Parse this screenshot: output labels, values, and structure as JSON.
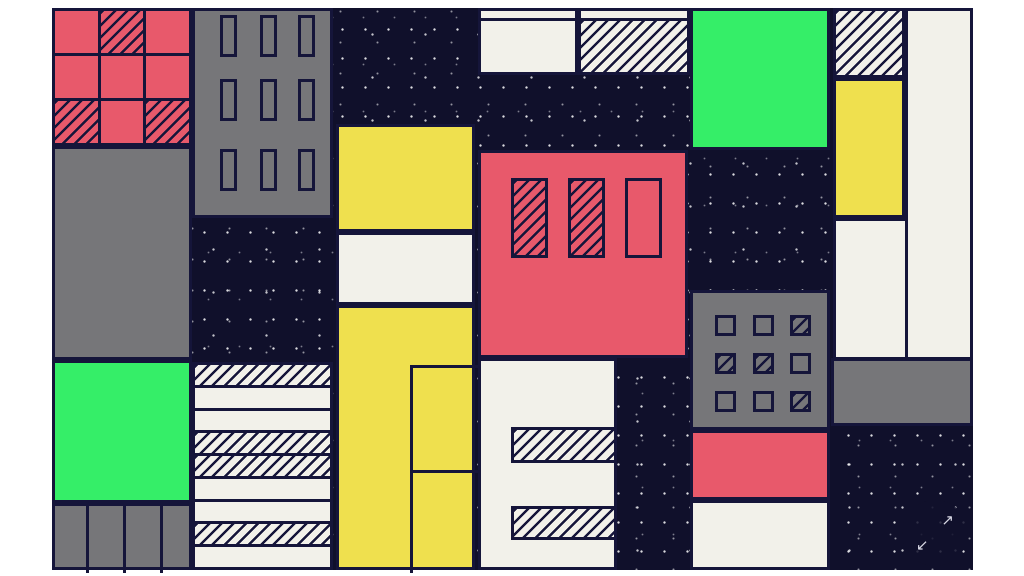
{
  "page": {
    "background": "#ffffff"
  },
  "artwork": {
    "description": "abstract geometric city-blocks illustration with hatched and speckled textures",
    "palette": {
      "navy": "#10102b",
      "red": "#e8596b",
      "gray": "#767679",
      "green": "#35ee68",
      "yellow": "#efe04e",
      "cream": "#f2f1ea",
      "line": "#15153a",
      "speckle": "#ffffff"
    },
    "canvas": {
      "x": 52,
      "y": 8,
      "width": 921,
      "height": 562
    },
    "blocks": [
      {
        "name": "red-grid",
        "x": 0,
        "y": 0,
        "w": 140,
        "h": 138,
        "fill": "red",
        "grid": {
          "rows": 3,
          "cols": 3,
          "hatch": [
            [
              0,
              1
            ],
            [
              2,
              0
            ],
            [
              2,
              2
            ]
          ]
        }
      },
      {
        "name": "left-gray-block",
        "x": 0,
        "y": 138,
        "w": 140,
        "h": 214,
        "fill": "gray"
      },
      {
        "name": "left-green-block",
        "x": 0,
        "y": 352,
        "w": 140,
        "h": 143,
        "fill": "green"
      },
      {
        "name": "left-gray-columns",
        "x": 0,
        "y": 495,
        "w": 140,
        "h": 67,
        "fill": "gray",
        "vlines": [
          31,
          68,
          105
        ]
      },
      {
        "name": "gray-building-top",
        "x": 140,
        "y": 0,
        "w": 141,
        "h": 210,
        "fill": "gray",
        "windows": {
          "cols": [
            25,
            65,
            103
          ],
          "rows": [
            4,
            68,
            138
          ],
          "w": 17,
          "h": 42,
          "hatch": []
        }
      },
      {
        "name": "stripe-building",
        "x": 140,
        "y": 354,
        "w": 141,
        "h": 208,
        "fill": "cream",
        "bands": [
          "hatch",
          "cream",
          "cream",
          "hatch",
          "hatch",
          "cream",
          "cream",
          "hatch",
          "cream"
        ]
      },
      {
        "name": "top-cream-strip-left",
        "x": 426,
        "y": 0,
        "w": 100,
        "h": 13,
        "fill": "cream"
      },
      {
        "name": "top-cream-strip-right",
        "x": 526,
        "y": 0,
        "w": 112,
        "h": 13,
        "fill": "cream"
      },
      {
        "name": "top-cream-left",
        "x": 426,
        "y": 10,
        "w": 100,
        "h": 57,
        "fill": "cream"
      },
      {
        "name": "top-hatch-right",
        "x": 526,
        "y": 10,
        "w": 112,
        "h": 57,
        "fill": "hatch"
      },
      {
        "name": "yellow-top-block",
        "x": 284,
        "y": 116,
        "w": 139,
        "h": 108,
        "fill": "yellow"
      },
      {
        "name": "center-cream-band",
        "x": 284,
        "y": 224,
        "w": 139,
        "h": 73,
        "fill": "cream"
      },
      {
        "name": "yellow-column",
        "x": 284,
        "y": 297,
        "w": 139,
        "h": 265,
        "fill": "yellow",
        "lines": [
          {
            "x": 71,
            "y": 57,
            "w": 3,
            "h": 208
          },
          {
            "x": 71,
            "y": 57,
            "w": 68,
            "h": 3
          },
          {
            "x": 71,
            "y": 162,
            "w": 68,
            "h": 3
          }
        ]
      },
      {
        "name": "red-building",
        "x": 426,
        "y": 142,
        "w": 210,
        "h": 208,
        "fill": "red",
        "windows": {
          "cols": [
            30,
            87,
            144
          ],
          "rows": [
            25
          ],
          "w": 37,
          "h": 80,
          "hatch": [
            [
              0,
              0
            ],
            [
              0,
              1
            ]
          ]
        }
      },
      {
        "name": "bottom-cream-center",
        "x": 426,
        "y": 350,
        "w": 139,
        "h": 212,
        "fill": "cream",
        "bars": [
          {
            "x": 30,
            "y": 66,
            "w": 106,
            "h": 36
          },
          {
            "x": 30,
            "y": 145,
            "w": 106,
            "h": 34
          }
        ]
      },
      {
        "name": "green-block-right",
        "x": 638,
        "y": 0,
        "w": 140,
        "h": 142,
        "fill": "green"
      },
      {
        "name": "gray-building-right",
        "x": 638,
        "y": 282,
        "w": 140,
        "h": 140,
        "fill": "gray",
        "windows": {
          "cols": [
            22,
            60,
            97
          ],
          "rows": [
            22,
            60,
            98
          ],
          "w": 21,
          "h": 21,
          "hatch": [
            [
              0,
              2
            ],
            [
              1,
              0
            ],
            [
              1,
              1
            ],
            [
              2,
              2
            ]
          ]
        }
      },
      {
        "name": "red-band-right",
        "x": 638,
        "y": 422,
        "w": 140,
        "h": 70,
        "fill": "red"
      },
      {
        "name": "cream-block-bottom-right",
        "x": 638,
        "y": 492,
        "w": 140,
        "h": 70,
        "fill": "cream"
      },
      {
        "name": "hatch-block-top-right",
        "x": 781,
        "y": 0,
        "w": 72,
        "h": 70,
        "fill": "hatch"
      },
      {
        "name": "yellow-block-right",
        "x": 781,
        "y": 70,
        "w": 72,
        "h": 140,
        "fill": "yellow"
      },
      {
        "name": "cream-column-right",
        "x": 853,
        "y": 0,
        "w": 68,
        "h": 352,
        "fill": "cream"
      },
      {
        "name": "cream-block-right",
        "x": 781,
        "y": 210,
        "w": 75,
        "h": 142,
        "fill": "cream"
      },
      {
        "name": "gray-band-right",
        "x": 779,
        "y": 350,
        "w": 142,
        "h": 68,
        "fill": "gray"
      }
    ]
  },
  "controls": {
    "expand_button": {
      "icon": "expand-arrows-icon",
      "x": 850,
      "y": 492,
      "size": 66,
      "arrow_ne": "↗",
      "arrow_sw": "↙"
    }
  }
}
